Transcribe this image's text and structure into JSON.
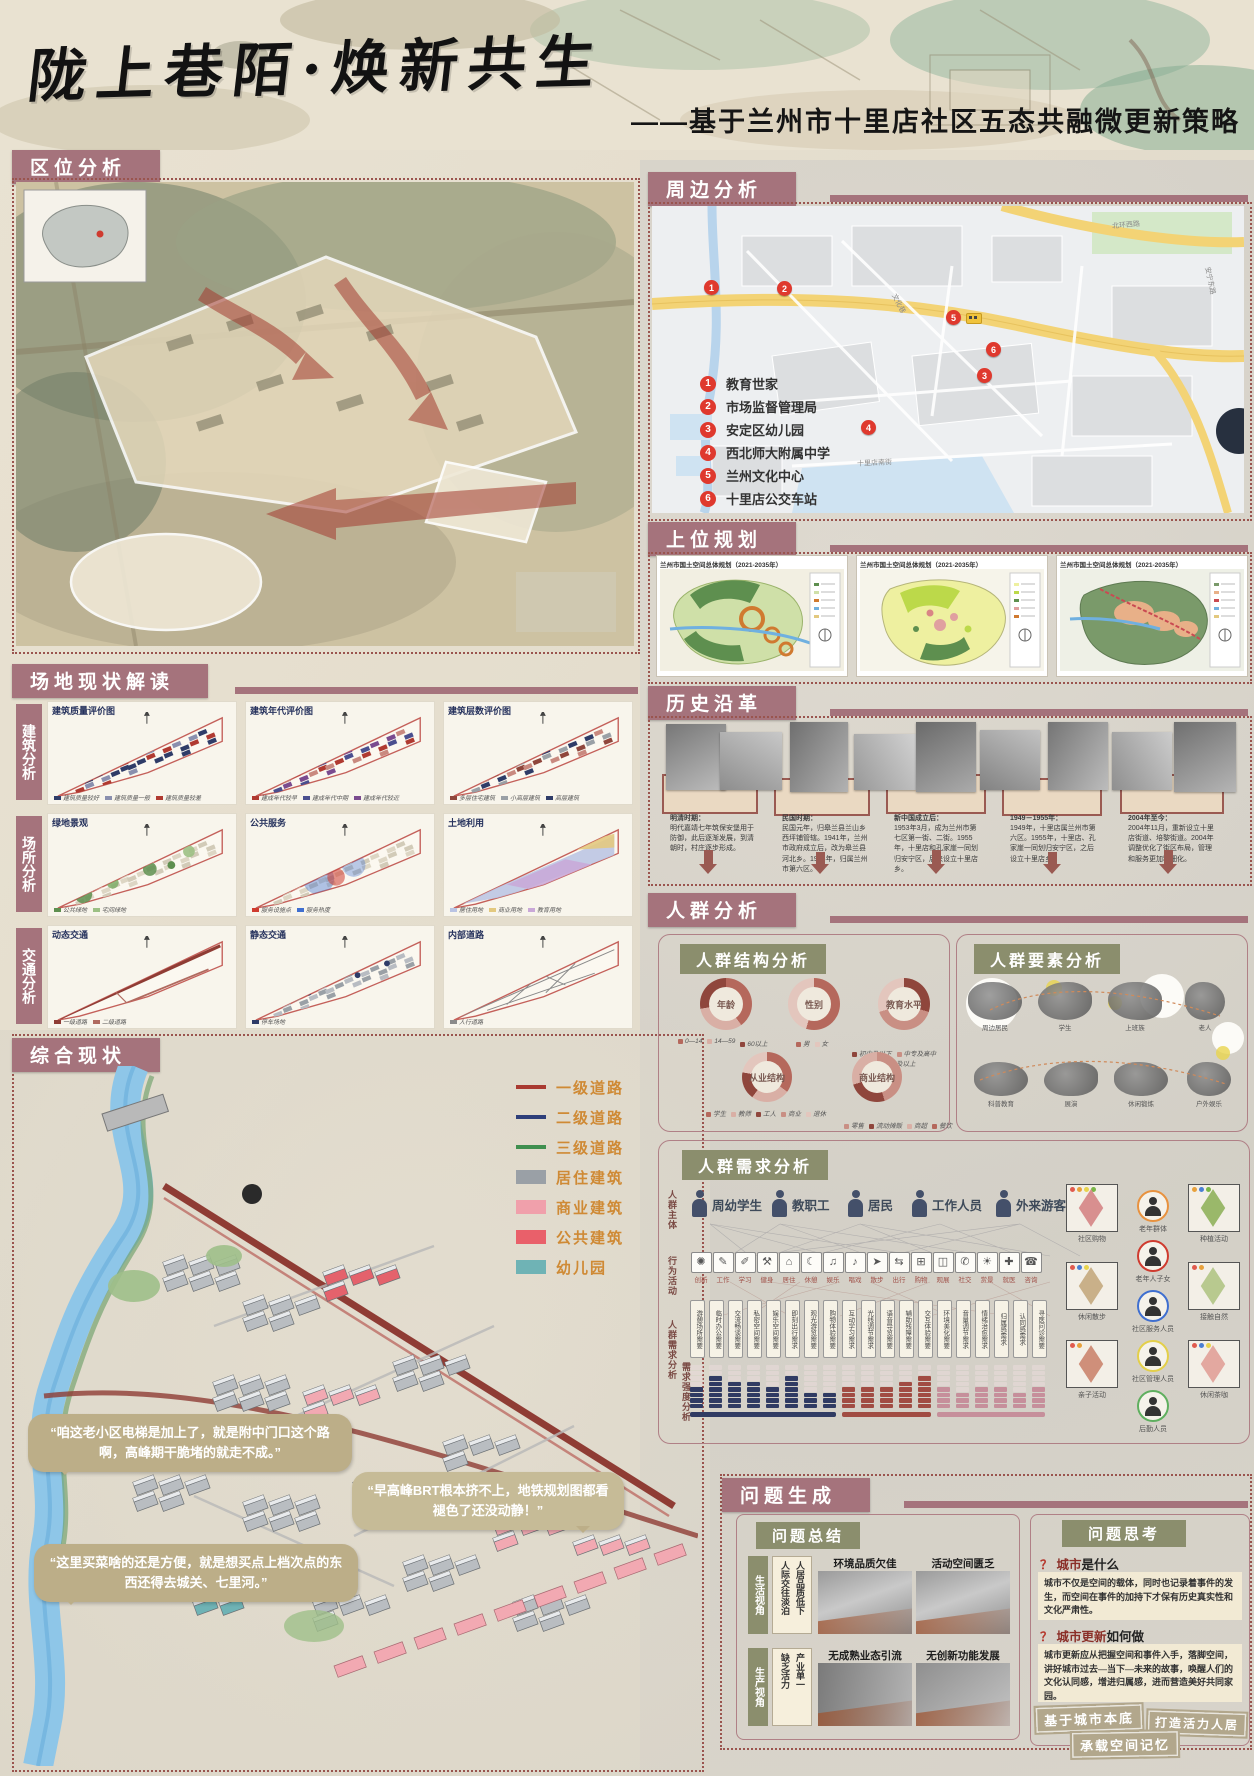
{
  "banner": {
    "title": "陇上巷陌·焕新共生",
    "subtitle": "——基于兰州市十里店社区五态共融微更新策略"
  },
  "quwei": {
    "header": "区位分析"
  },
  "changdi": {
    "header": "场地现状解读",
    "rows": [
      {
        "label": "建筑分析",
        "maps": [
          {
            "title": "建筑质量评价图",
            "legend": [
              "建筑质量较好",
              "建筑质量一般",
              "建筑质量较差"
            ]
          },
          {
            "title": "建筑年代评价图",
            "legend": [
              "建成年代较早",
              "建成年代中期",
              "建成年代较近"
            ]
          },
          {
            "title": "建筑层数评价图",
            "legend": [
              "多层住宅建筑",
              "小高层建筑",
              "高层建筑"
            ]
          }
        ]
      },
      {
        "label": "场所分析",
        "maps": [
          {
            "title": "绿地景观",
            "legend": [
              "公共绿地",
              "宅间绿地"
            ]
          },
          {
            "title": "公共服务",
            "legend": [
              "服务设施点",
              "服务热度"
            ]
          },
          {
            "title": "土地利用",
            "legend": [
              "居住用地",
              "商业用地",
              "教育用地"
            ]
          }
        ]
      },
      {
        "label": "交通分析",
        "maps": [
          {
            "title": "动态交通",
            "legend": [
              "一级道路",
              "二级道路"
            ]
          },
          {
            "title": "静态交通",
            "legend": [
              "停车场地"
            ]
          },
          {
            "title": "内部道路",
            "legend": [
              "人行道路"
            ]
          }
        ]
      }
    ]
  },
  "zonghe": {
    "header": "综合现状",
    "legend": [
      {
        "label": "一级道路",
        "type": "line",
        "color": "#a93a31"
      },
      {
        "label": "二级道路",
        "type": "line",
        "color": "#2e3f7a"
      },
      {
        "label": "三级道路",
        "type": "line",
        "color": "#3f8f4f"
      },
      {
        "label": "居住建筑",
        "type": "box",
        "color": "#9aa0a6"
      },
      {
        "label": "商业建筑",
        "type": "box",
        "color": "#f0a0ab"
      },
      {
        "label": "公共建筑",
        "type": "box",
        "color": "#e9606a"
      },
      {
        "label": "幼儿园",
        "type": "box",
        "color": "#6fb3b5"
      }
    ],
    "bubbles": [
      "“咱这老小区电梯是加上了，就是附中门口这个路啊，高峰期干脆堵的就走不成。”",
      "“早高峰BRT根本挤不上，地铁规划图都看褪色了还没动静！”",
      "“这里买菜啥的还是方便，就是想买点上档次点的东西还得去城关、七里河。”"
    ]
  },
  "zhoubian": {
    "header": "周边分析",
    "legend": [
      {
        "num": "1",
        "label": "教育世家"
      },
      {
        "num": "2",
        "label": "市场监督管理局"
      },
      {
        "num": "3",
        "label": "安定区幼儿园"
      },
      {
        "num": "4",
        "label": "西北师大附属中学"
      },
      {
        "num": "5",
        "label": "兰州文化中心"
      },
      {
        "num": "6",
        "label": "十里店公交车站"
      }
    ],
    "map_labels": [
      "北环西路",
      "安宁东路",
      "文化巷",
      "十里店南街"
    ]
  },
  "shangwei": {
    "header": "上位规划",
    "maps": [
      {
        "title": "兰州市国土空间总体规划（2021-2035年）"
      },
      {
        "title": "兰州市国土空间总体规划（2021-2035年）"
      },
      {
        "title": "兰州市国土空间总体规划（2021-2035年）"
      }
    ]
  },
  "lishi": {
    "header": "历史沿革",
    "eras": [
      {
        "title": "明清时期：",
        "text": "明代嘉靖七年筑保安堡用于防御，此后逐渐发展，到清朝时，村庄逐步形成。"
      },
      {
        "title": "民国时期：",
        "text": "民国元年，归皋兰县兰山乡西坪铺管辖。1941年，兰州市政府成立后，改为皋兰县河北乡。1944年，归属兰州市第六区。"
      },
      {
        "title": "新中国成立后：",
        "text": "1953年3月，成为兰州市第七区第一街、二街。1955年，十里店和孔家崖一同划归安宁区，后来设立十里店乡。"
      },
      {
        "title": "1949－1955年：",
        "text": "1949年，十里店属兰州市第六区。1955年，十里店、孔家崖一同划归安宁区，之后设立十里店乡。"
      },
      {
        "title": "2004年至今：",
        "text": "2004年11月，重新设立十里店街道、培黎街道。2004年调整优化了街区布局，管理和服务更加精细化。"
      }
    ]
  },
  "renqun": {
    "header": "人群分析",
    "jiegou": {
      "title": "人群结构分析",
      "donuts": [
        {
          "name": "年龄",
          "legend": [
            "0—14",
            "14—59",
            "60以上"
          ]
        },
        {
          "name": "性别",
          "legend": [
            "男",
            "女"
          ]
        },
        {
          "name": "教育水平",
          "legend": [
            "初中及以下",
            "中专及高中",
            "大专及以上"
          ]
        },
        {
          "name": "从业结构",
          "legend": [
            "学生",
            "教师",
            "工人",
            "商业",
            "退休"
          ]
        },
        {
          "name": "商业结构",
          "legend": [
            "零售",
            "流动摊贩",
            "商超",
            "餐饮"
          ]
        }
      ]
    },
    "yaosu": {
      "title": "人群要素分析",
      "groups_top": [
        "周边居民",
        "学生",
        "上班族",
        "老人"
      ],
      "groups_bottom": [
        "科普教育",
        "展演",
        "休闲锻炼",
        "户外娱乐"
      ]
    },
    "xuqiu": {
      "title": "人群需求分析",
      "row_labels": [
        "人群主体",
        "行为活动",
        "人群需求分析",
        "需求强度分析"
      ],
      "subjects": [
        "周幼学生",
        "教职工",
        "居民",
        "工作人员",
        "外来游客"
      ],
      "activities": [
        {
          "label": "创新",
          "glyph": "✺"
        },
        {
          "label": "工作",
          "glyph": "✎"
        },
        {
          "label": "学习",
          "glyph": "✐"
        },
        {
          "label": "健身",
          "glyph": "⚒"
        },
        {
          "label": "居住",
          "glyph": "⌂"
        },
        {
          "label": "休憩",
          "glyph": "☾"
        },
        {
          "label": "娱乐",
          "glyph": "♫"
        },
        {
          "label": "唱戏",
          "glyph": "♪"
        },
        {
          "label": "散步",
          "glyph": "➤"
        },
        {
          "label": "出行",
          "glyph": "⇆"
        },
        {
          "label": "购物",
          "glyph": "⊞"
        },
        {
          "label": "观展",
          "glyph": "◫"
        },
        {
          "label": "社交",
          "glyph": "✆"
        },
        {
          "label": "赏景",
          "glyph": "☀"
        },
        {
          "label": "就医",
          "glyph": "✚"
        },
        {
          "label": "咨询",
          "glyph": "☎"
        }
      ],
      "needs": [
        {
          "label": "游憩场所需要",
          "group": 0,
          "value": 4
        },
        {
          "label": "临时办公需要",
          "group": 0,
          "value": 6
        },
        {
          "label": "交流畅谈需要",
          "group": 0,
          "value": 5
        },
        {
          "label": "私密空间需要",
          "group": 0,
          "value": 5
        },
        {
          "label": "娱乐空间需要",
          "group": 0,
          "value": 4
        },
        {
          "label": "即刻出行需求",
          "group": 0,
          "value": 6
        },
        {
          "label": "观光游览需要",
          "group": 0,
          "value": 3
        },
        {
          "label": "购物体验需要",
          "group": 0,
          "value": 3
        },
        {
          "label": "互动学习需求",
          "group": 1,
          "value": 4
        },
        {
          "label": "光线调节需求",
          "group": 1,
          "value": 4
        },
        {
          "label": "语音导览需要",
          "group": 1,
          "value": 4
        },
        {
          "label": "辅助残障需要",
          "group": 1,
          "value": 5
        },
        {
          "label": "交互体验需要",
          "group": 1,
          "value": 6
        },
        {
          "label": "环境美化需要",
          "group": 2,
          "value": 4
        },
        {
          "label": "音量调节需求",
          "group": 2,
          "value": 3
        },
        {
          "label": "情绪治愈需求",
          "group": 2,
          "value": 4
        },
        {
          "label": "归属感需求",
          "group": 2,
          "value": 4
        },
        {
          "label": "认同感需求",
          "group": 2,
          "value": 3
        },
        {
          "label": "寻医问诊需要",
          "group": 2,
          "value": 4
        }
      ],
      "group_colors": [
        "#303b63",
        "#a14c43",
        "#c68f9b"
      ],
      "ghost_color": "#e9dada",
      "tiles": [
        {
          "label": "社区购物",
          "dots": [
            "#e05a4e",
            "#e8a13c",
            "#e8d44d",
            "#7ab648"
          ],
          "fill": "#d88f8f"
        },
        {
          "label": "休闲散步",
          "dots": [
            "#e05a4e",
            "#4a7fd4",
            "#e8d44d"
          ],
          "fill": "#c9b089"
        },
        {
          "label": "亲子活动",
          "dots": [
            "#e05a4e",
            "#e8a13c"
          ],
          "fill": "#cf8f7a"
        },
        {
          "label": "种植活动",
          "dots": [
            "#e8a13c",
            "#4a7fd4",
            "#7ab648"
          ],
          "fill": "#9ab86a"
        },
        {
          "label": "接触自然",
          "dots": [
            "#e05a4e",
            "#e8a13c"
          ],
          "fill": "#b8c98f"
        },
        {
          "label": "休闲茶咖",
          "dots": [
            "#e05a4e",
            "#4a7fd4",
            "#e8d44d"
          ],
          "fill": "#e3a8a0"
        }
      ],
      "personas_right": [
        {
          "label": "老年群体",
          "ring": "#e8923f"
        },
        {
          "label": "老年人子女",
          "ring": "#cf3b2f"
        },
        {
          "label": "社区服务人员",
          "ring": "#3f6fd0"
        },
        {
          "label": "社区管理人员",
          "ring": "#e3cf4a"
        },
        {
          "label": "后勤人员",
          "ring": "#5faf5f"
        }
      ]
    }
  },
  "wenti": {
    "header": "问题生成",
    "zongjie": {
      "title": "问题总结",
      "rows": [
        {
          "angle": "生活视角",
          "tags": [
            "人际交往淡泊",
            "人居品质低下"
          ],
          "photos": [
            "环境品质欠佳",
            "活动空间匮乏"
          ]
        },
        {
          "angle": "生产视角",
          "tags": [
            "缺乏活力",
            "产业单一"
          ],
          "photos": [
            "无成熟业态引流",
            "无创新功能发展"
          ]
        }
      ]
    },
    "sikao": {
      "title": "问题思考",
      "q1_mark": "？",
      "q1_key": "城市",
      "q1_rest": "是什么",
      "a1": "城市不仅是空间的载体，同时也记录着事件的发生，而空间在事件的加持下才保有历史真实性和文化严肃性。",
      "q2_mark": "？",
      "q2_key": "城市更新",
      "q2_rest": "如何做",
      "a2": "城市更新应从把握空间和事件入手，落脚空间，讲好城市过去—当下—未来的故事，唤醒人们的文化认同感，增进归属感，进而营造美好共同家园。",
      "stamps": [
        "基于城市本底",
        "打造活力人居",
        "承载空间记忆"
      ]
    }
  }
}
